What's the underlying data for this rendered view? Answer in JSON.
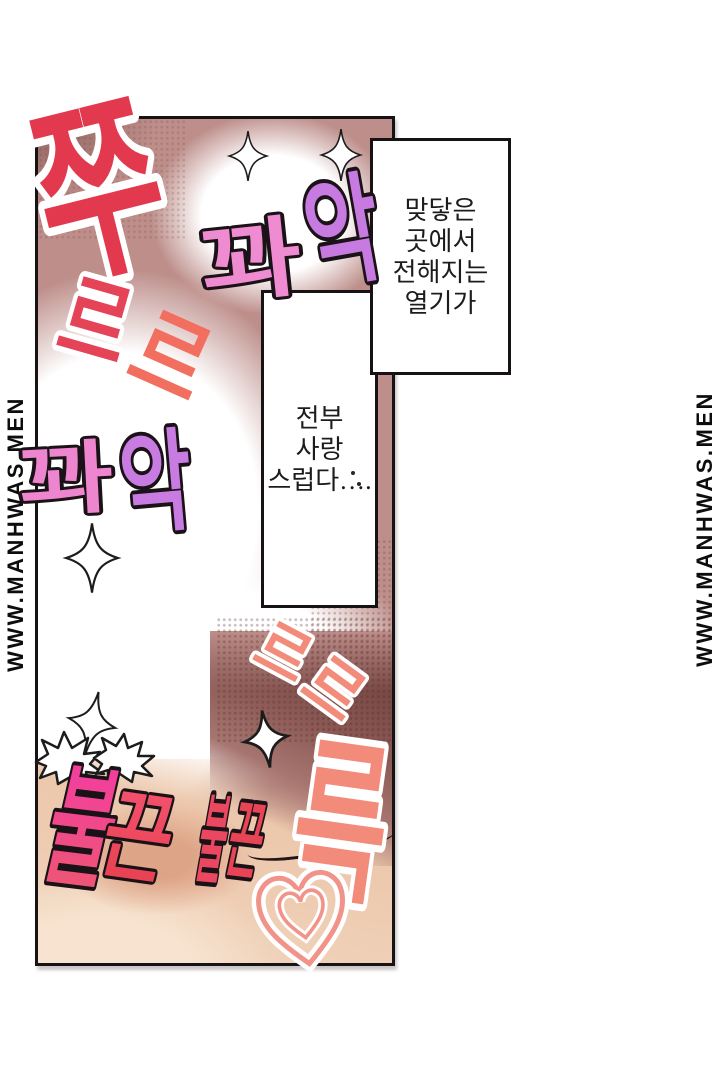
{
  "comic": {
    "watermark_left": "WWW.MANHWAS.MEN",
    "watermark_right": "WWW.MANHWAS.MEN"
  },
  "speech_boxes": [
    {
      "lines": [
        "맞닿은",
        "곳에서",
        "전해지는",
        "열기가"
      ]
    },
    {
      "lines": [
        "전부",
        "사랑",
        "스럽다…."
      ]
    }
  ],
  "sfx": {
    "jju": {
      "text": "쭈",
      "fill": "#e2394f",
      "outline": "#ffffff"
    },
    "reu1": {
      "text": "르",
      "fill": "#e54458",
      "outline": "#ffffff"
    },
    "reu2": {
      "text": "르",
      "fill": "#f26e5f"
    },
    "kwaak1": {
      "chars": [
        "꽈",
        "악"
      ],
      "fills": [
        "#ef8bd0",
        "#c77be0"
      ],
      "outline": "#1a1216"
    },
    "kwaak2": {
      "chars": [
        "꽈",
        "악"
      ],
      "fills": [
        "#ee86cf",
        "#c87ce2"
      ],
      "outline": "#1a1216"
    },
    "reu3": {
      "text": "르",
      "fill": "#f28b7a",
      "outline": "#ffffff"
    },
    "reu4": {
      "text": "르",
      "fill": "#f28b7a",
      "outline": "#ffffff"
    },
    "reuk": {
      "text": "륵",
      "fill": "#f28b7a",
      "outline": "#ffffff"
    },
    "bulkkeun1": {
      "chars": [
        "불",
        "끈"
      ],
      "fills": [
        [
          "#f33f9c",
          "#ee5477"
        ],
        [
          "#f2506b",
          "#e84253"
        ]
      ],
      "outline": "#1a1216"
    },
    "bulkkeun2": {
      "chars": [
        "불",
        "끈"
      ],
      "fills": [
        "#ea4861",
        "#e74556"
      ],
      "outline": "#1a1216"
    }
  },
  "art": {
    "panel_base": "#bd8e8a",
    "panel_dark": "#6e403d",
    "skin": "#ecc7ab",
    "skin_light": "#f7e3cf",
    "blush": "#db9d80",
    "glow": "#ffffff",
    "heart_line": "#f2938a",
    "sparkle_fill": "#ffffff",
    "sparkle_line": "#1c1c1c"
  }
}
